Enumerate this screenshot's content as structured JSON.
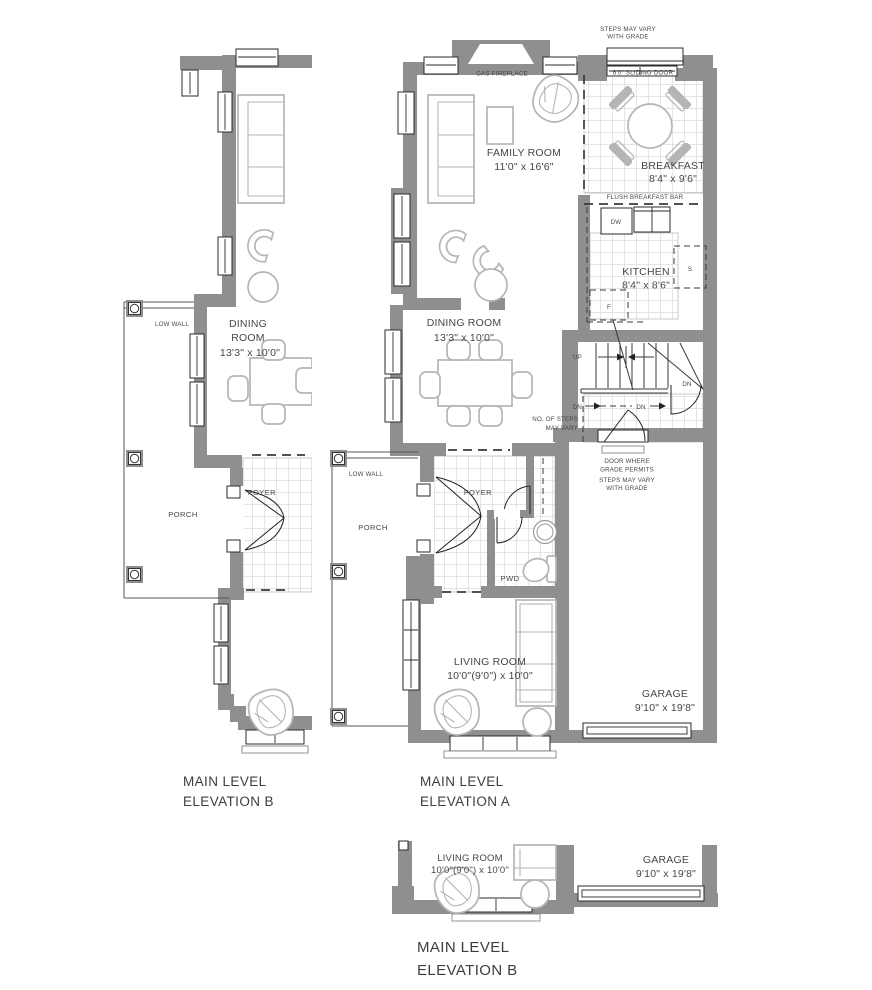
{
  "colors": {
    "wall": "#8f8f8f",
    "furniture": "#b5b5b5",
    "tile": "#cbcbcb",
    "line": "#2e2e2e",
    "text": "#474747"
  },
  "plan_a": {
    "title_line1": "MAIN LEVEL",
    "title_line2": "ELEVATION A",
    "labels": {
      "steps_note_line1": "STEPS MAY VARY",
      "steps_note_line2": "WITH GRADE",
      "gas_fireplace": "GAS FIREPLACE",
      "sliding_door": "6'0\" SLIDING DOOR",
      "family_room": "FAMILY ROOM",
      "family_room_dims": "11'0\" x 16'6\"",
      "breakfast": "BREAKFAST",
      "breakfast_dims": "8'4\" x 9'6\"",
      "flush_breakfast_bar": "FLUSH BREAKFAST BAR",
      "dishwasher": "DW",
      "kitchen": "KITCHEN",
      "kitchen_dims": "8'4\" x 8'6\"",
      "sink": "S",
      "fridge": "F",
      "up": "UP",
      "dn": "DN",
      "dining_room": "DINING ROOM",
      "dining_room_dims": "13'3\" x 10'0\"",
      "steps_vary_line1": "NO. OF STEPS",
      "steps_vary_line2": "MAY VARY",
      "low_wall": "LOW WALL",
      "porch": "PORCH",
      "foyer": "FOYER",
      "pwd": "PWD",
      "door_grade_line1": "DOOR  WHERE",
      "door_grade_line2": "GRADE PERMITS",
      "grade_steps_line1": "STEPS MAY VARY",
      "grade_steps_line2": "WITH GRADE",
      "living_room": "LIVING ROOM",
      "living_room_dims": "10'0\"(9'0\") x 10'0\"",
      "garage": "GARAGE",
      "garage_dims": "9'10\" x 19'8\""
    }
  },
  "plan_b_left": {
    "title_line1": "MAIN LEVEL",
    "title_line2": "ELEVATION B",
    "labels": {
      "dining_line1": "DINING",
      "dining_line2": "ROOM",
      "dining_dims": "13'3\" x 10'0\"",
      "low_wall": "LOW WALL",
      "porch": "PORCH",
      "foyer": "FOYER"
    }
  },
  "plan_b_bottom": {
    "title_line1": "MAIN LEVEL",
    "title_line2": "ELEVATION B",
    "labels": {
      "living_room": "LIVING ROOM",
      "living_room_dims": "10'0\"(9'0\") x 10'0\"",
      "garage": "GARAGE",
      "garage_dims": "9'10\" x 19'8\""
    }
  }
}
